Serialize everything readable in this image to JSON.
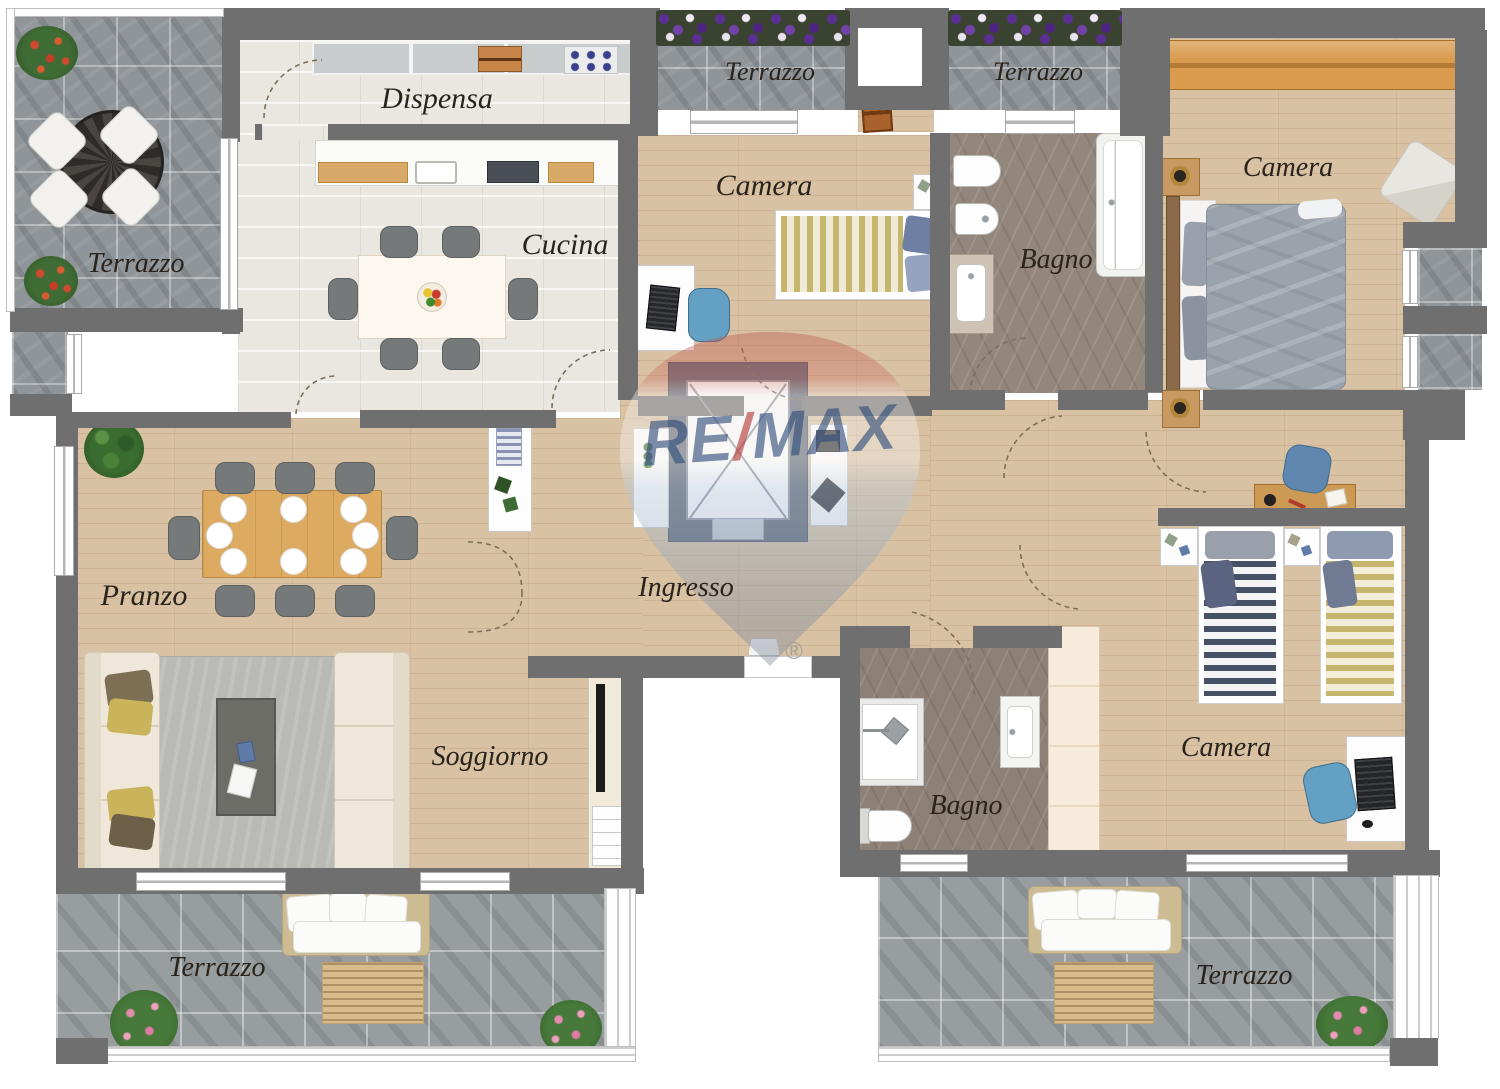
{
  "document": {
    "type": "apartment-floor-plan",
    "language": "it"
  },
  "labels": {
    "terrazzo_top_left": "Terrazzo",
    "dispensa": "Dispensa",
    "cucina": "Cucina",
    "terrazzo_top_center": "Terrazzo",
    "camera_top_center": "Camera",
    "bagno_top": "Bagno",
    "terrazzo_top_right": "Terrazzo",
    "camera_top_right": "Camera",
    "pranzo": "Pranzo",
    "ingresso": "Ingresso",
    "soggiorno": "Soggiorno",
    "bagno_bottom": "Bagno",
    "camera_bottom_right": "Camera",
    "terrazzo_bottom_left": "Terrazzo",
    "terrazzo_bottom_right": "Terrazzo"
  },
  "watermark": {
    "re": "RE",
    "slash": "/",
    "max": "MAX",
    "registered": "®",
    "text_blue": "#2d4b7a",
    "slash_red": "#b23a36",
    "balloon_red": "#bf574e",
    "balloon_blue": "#8895a8"
  },
  "palette": {
    "wall": "#6f6f6f",
    "wood_floor": "#d8c2a3",
    "terrace_tile": "#8f9599",
    "kitchen_tile": "#eae7e0",
    "bath_marble": "#93867c",
    "wardrobe_wood": "#d99b4e",
    "dining_table_wood": "#dcaa60",
    "gold_stripe": "#c6b66d",
    "navy_stripe": "#475166",
    "duvet_gray": "#9aa2ac"
  }
}
